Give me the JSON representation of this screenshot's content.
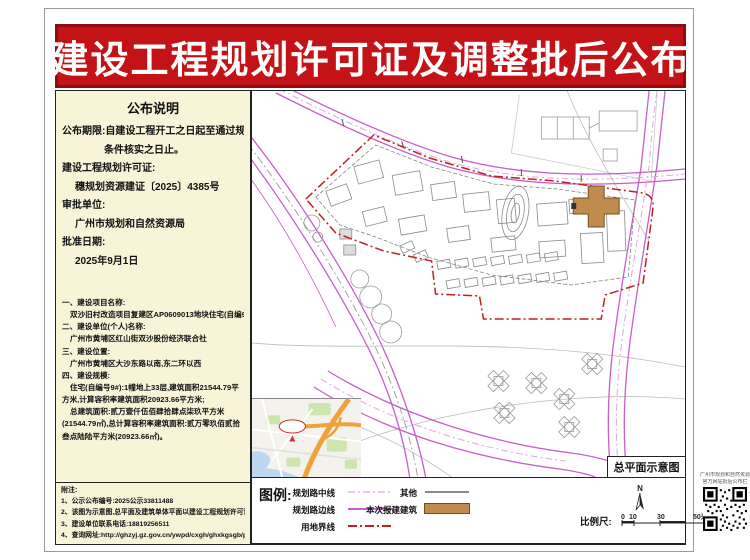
{
  "banner": {
    "title": "建设工程规划许可证及调整批后公布"
  },
  "notice": {
    "title": "公布说明",
    "period1": "公布期限:自建设工程开工之日起至通过规划",
    "period2": "条件核实之日止。",
    "permit_label": "建设工程规划许可证:",
    "permit_no": "穗规划资源建证〔2025〕4385号",
    "approver_label": "审批单位:",
    "approver": "广州市规划和自然资源局",
    "date_label": "批准日期:",
    "date": "2025年9月1日"
  },
  "project": {
    "s1_label": "一、建设项目名称:",
    "s1_value": "双沙旧村改造项目复建区AP0609013地块住宅(自编9#)",
    "s2_label": "二、建设单位(个人)名称:",
    "s2_value": "广州市黄埔区红山街双沙股份经济联合社",
    "s3_label": "三、建设位置:",
    "s3_value": "广州市黄埔区大沙东路以南,东二环以西",
    "s4_label": "四、建设规模:",
    "s4_line1": "住宅(自编号9#):1幢地上33层,建筑面积21544.79平方米,计算容积率建筑面积20923.66平方米;",
    "s4_line2": "总建筑面积:贰万壹仟伍佰肆拾肆点柒玖平方米(21544.79㎡),总计算容积率建筑面积:贰万零玖佰贰拾叁点陆陆平方米(20923.66㎡)。"
  },
  "notes": {
    "title": "附注:",
    "items": [
      "1、公示公布编号:2025公示33811488",
      "2、该图为示意图,总平面及建筑单体平面以建设工程规划许可证附图为准。",
      "3、建设单位联系电话:18819256511",
      "4、查询网址:http://ghzyj.gz.gov.cn/ywpd/cxgh/ghxkgsgb/phgb/gbt/"
    ]
  },
  "map": {
    "caption": "总平面示意图"
  },
  "legend": {
    "title": "图例:",
    "item_center": "规划路中线",
    "item_edge": "规划路边线",
    "item_land": "用地界线",
    "item_other": "其他",
    "item_new": "本次报建建筑",
    "north": "N",
    "scale_label": "比例尺:",
    "scale_0": "0",
    "scale_10": "10",
    "scale_30": "30",
    "scale_50": "50米"
  },
  "qr": {
    "line1": "广州市规划和自然资源局",
    "line2": "官方网站批后公布栏"
  },
  "colors": {
    "banner_red": "#c41317",
    "banner_border": "#8d0d10",
    "panel_bg": "#f8f4d8",
    "road_magenta": "#c75fc7",
    "road_center_pink": "#dfa6df",
    "boundary_red": "#c02020",
    "new_building_tan": "#c28b4e"
  }
}
